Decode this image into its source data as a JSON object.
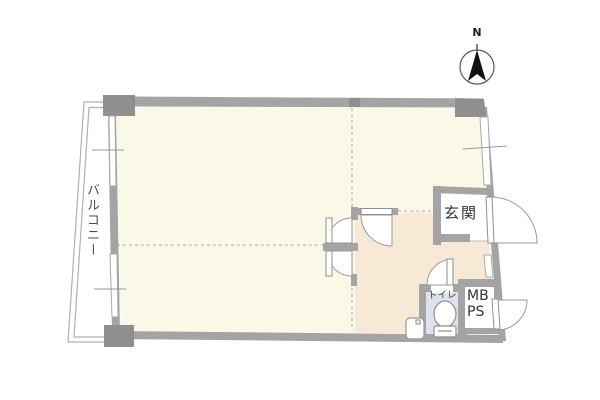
{
  "floorplan": {
    "compass": {
      "north_label": "N"
    },
    "labels": {
      "balcony": "バルコニー",
      "entrance": "玄関",
      "toilet": "トイレ",
      "meter_box": "MB",
      "pipe_space": "PS"
    },
    "colors": {
      "background": "#ffffff",
      "room_floor": "#faf8e6",
      "hallway_floor": "#f8e9d6",
      "toilet_floor": "#dde3ec",
      "genkan_floor": "#ffffff",
      "wall": "#a4a4a4",
      "wall_dark": "#8f8f8f",
      "thin_line": "#aaaaaa",
      "dashed_line": "#bcbcbc"
    }
  }
}
